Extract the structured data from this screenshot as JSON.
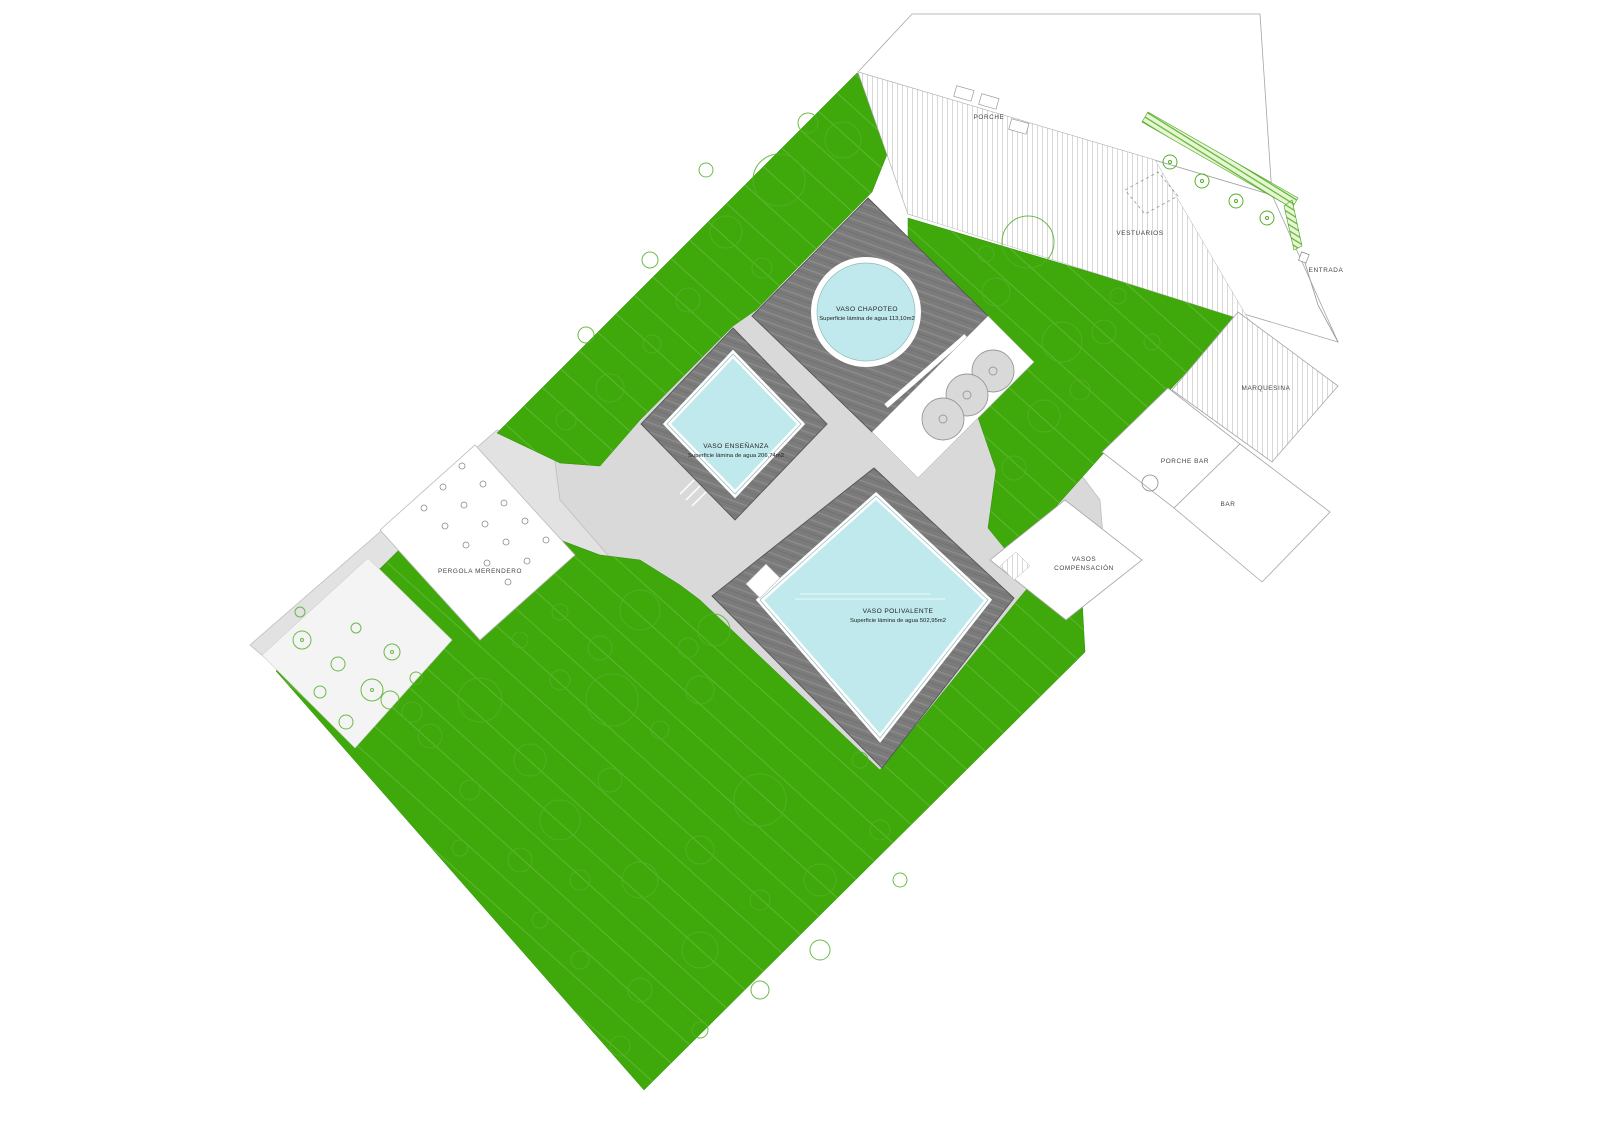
{
  "plan": {
    "labels": {
      "porche": "PORCHE",
      "vestuarios": "VESTUARIOS",
      "entrada": "ENTRADA",
      "marquesina": "MARQUESINA",
      "porche_bar": "PORCHE BAR",
      "bar": "BAR",
      "vasos_compensacion_1": "VASOS",
      "vasos_compensacion_2": "COMPENSACIÓN",
      "pergola": "PERGOLA MERENDERO"
    },
    "pools": {
      "chapoteo": {
        "name": "VASO CHAPOTEO",
        "area": "Superficie lámina de agua 113,10m2"
      },
      "ensenanza": {
        "name": "VASO ENSEÑANZA",
        "area": "Superficie lámina de agua 206,74m2"
      },
      "polivalente": {
        "name": "VASO POLIVALENTE",
        "area": "Superficie lámina de agua 502,95m2"
      }
    },
    "colors": {
      "grass": "#3fa90b",
      "water": "#bfe9ec",
      "deck": "#7b7b7b",
      "path": "#d9d9d9",
      "hedge": "#5ab52a"
    }
  }
}
